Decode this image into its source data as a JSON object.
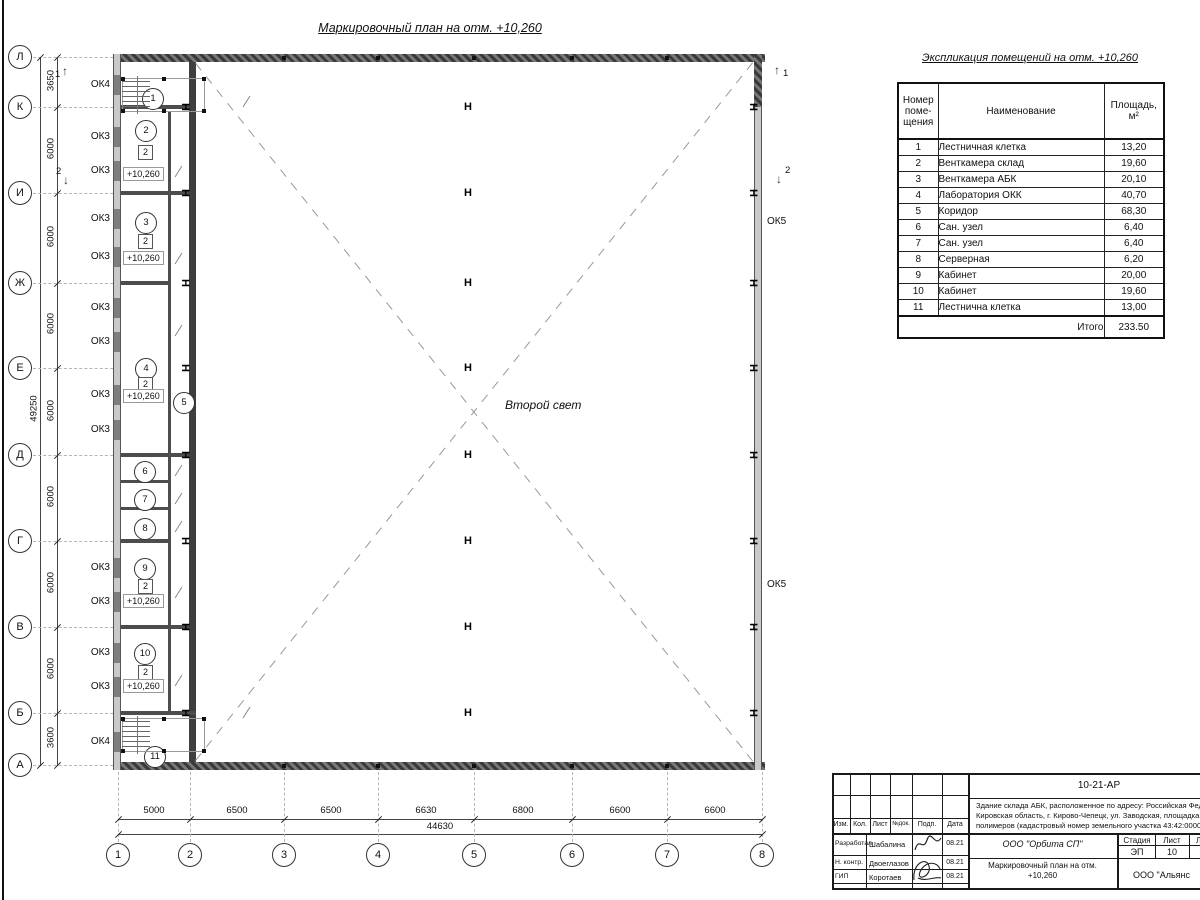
{
  "sheet": {
    "plan_title": "Маркировочный план на отм. +10,260",
    "second_light": "Второй свет"
  },
  "plan": {
    "row_axes": [
      {
        "label": "Л",
        "y": 57
      },
      {
        "label": "К",
        "y": 107
      },
      {
        "label": "И",
        "y": 193
      },
      {
        "label": "Ж",
        "y": 283
      },
      {
        "label": "Е",
        "y": 368
      },
      {
        "label": "Д",
        "y": 455
      },
      {
        "label": "Г",
        "y": 541
      },
      {
        "label": "В",
        "y": 627
      },
      {
        "label": "Б",
        "y": 713
      },
      {
        "label": "А",
        "y": 765
      }
    ],
    "col_axes": [
      {
        "label": "1",
        "x": 118
      },
      {
        "label": "2",
        "x": 190
      },
      {
        "label": "3",
        "x": 284
      },
      {
        "label": "4",
        "x": 378
      },
      {
        "label": "5",
        "x": 474
      },
      {
        "label": "6",
        "x": 572
      },
      {
        "label": "7",
        "x": 667
      },
      {
        "label": "8",
        "x": 762
      }
    ],
    "v_dims": [
      {
        "text": "3650",
        "y": 82
      },
      {
        "text": "6000",
        "y": 150
      },
      {
        "text": "6000",
        "y": 238
      },
      {
        "text": "6000",
        "y": 325
      },
      {
        "text": "6000",
        "y": 412
      },
      {
        "text": "6000",
        "y": 498
      },
      {
        "text": "6000",
        "y": 584
      },
      {
        "text": "6000",
        "y": 670
      },
      {
        "text": "3600",
        "y": 739
      }
    ],
    "v_total": {
      "text": "49250",
      "y": 410
    },
    "h_dims": [
      {
        "text": "5000",
        "x": 154
      },
      {
        "text": "6500",
        "x": 237
      },
      {
        "text": "6500",
        "x": 331
      },
      {
        "text": "6630",
        "x": 426
      },
      {
        "text": "6800",
        "x": 523
      },
      {
        "text": "6600",
        "x": 620
      },
      {
        "text": "6600",
        "x": 715
      }
    ],
    "h_total": {
      "text": "44630",
      "x": 440
    },
    "windows": [
      {
        "t": "ОК4",
        "y": 85
      },
      {
        "t": "ОК3",
        "y": 137
      },
      {
        "t": "ОК3",
        "y": 171
      },
      {
        "t": "ОК3",
        "y": 219
      },
      {
        "t": "ОК3",
        "y": 257
      },
      {
        "t": "ОК3",
        "y": 308
      },
      {
        "t": "ОК3",
        "y": 342
      },
      {
        "t": "ОК3",
        "y": 395
      },
      {
        "t": "ОК3",
        "y": 430
      },
      {
        "t": "ОК3",
        "y": 568
      },
      {
        "t": "ОК3",
        "y": 602
      },
      {
        "t": "ОК3",
        "y": 653
      },
      {
        "t": "ОК3",
        "y": 687
      },
      {
        "t": "ОК4",
        "y": 742
      }
    ],
    "ok5_labels": [
      {
        "t": "ОК5",
        "y": 222
      },
      {
        "t": "ОК5",
        "y": 585
      }
    ],
    "room_marks": [
      {
        "n": "1",
        "x": 152,
        "y": 98
      },
      {
        "n": "2",
        "x": 145,
        "y": 130
      },
      {
        "n": "3",
        "x": 145,
        "y": 222
      },
      {
        "n": "4",
        "x": 145,
        "y": 368
      },
      {
        "n": "5",
        "x": 183,
        "y": 402
      },
      {
        "n": "6",
        "x": 144,
        "y": 471
      },
      {
        "n": "7",
        "x": 144,
        "y": 499
      },
      {
        "n": "8",
        "x": 144,
        "y": 528
      },
      {
        "n": "9",
        "x": 144,
        "y": 568
      },
      {
        "n": "10",
        "x": 144,
        "y": 653
      },
      {
        "n": "11",
        "x": 154,
        "y": 756
      }
    ],
    "type_marks": [
      {
        "t": "2",
        "x": 145,
        "y": 152
      },
      {
        "t": "2",
        "x": 145,
        "y": 241
      },
      {
        "t": "2",
        "x": 145,
        "y": 384
      },
      {
        "t": "2",
        "x": 145,
        "y": 586
      },
      {
        "t": "2",
        "x": 145,
        "y": 672
      }
    ],
    "level_labels": [
      {
        "t": "+10,260",
        "x": 146,
        "y": 174
      },
      {
        "t": "+10,260",
        "x": 146,
        "y": 258
      },
      {
        "t": "+10,260",
        "x": 146,
        "y": 396
      },
      {
        "t": "+10,260",
        "x": 146,
        "y": 601
      },
      {
        "t": "+10,260",
        "x": 146,
        "y": 686
      }
    ],
    "section_marks": [
      {
        "t": "1",
        "ax": 68,
        "ay": 71,
        "lx": 59,
        "ly": 75,
        "dir": "up"
      },
      {
        "t": "1",
        "ax": 780,
        "ay": 70,
        "lx": 787,
        "ly": 74,
        "dir": "up"
      },
      {
        "t": "2",
        "ax": 69,
        "ay": 180,
        "lx": 60,
        "ly": 172,
        "dir": "down"
      },
      {
        "t": "2",
        "ax": 782,
        "ay": 179,
        "lx": 789,
        "ly": 171,
        "dir": "down"
      }
    ],
    "door_slashes": [
      [
        240,
        101
      ],
      [
        172,
        171
      ],
      [
        172,
        258
      ],
      [
        172,
        330
      ],
      [
        172,
        470
      ],
      [
        172,
        498
      ],
      [
        172,
        526
      ],
      [
        172,
        592
      ],
      [
        172,
        680
      ],
      [
        240,
        712
      ]
    ],
    "h_columns": {
      "t": "Н",
      "mid_x": 464,
      "left_x": 181,
      "right_x": 749,
      "ys": [
        107,
        193,
        283,
        368,
        455,
        541,
        627,
        713
      ]
    }
  },
  "schedule": {
    "title": "Экспликация помещений на отм. +10,260",
    "headers": [
      "Номер\nпоме-\nщения",
      "Наименование",
      "Площадь,\nм²"
    ],
    "rows": [
      [
        "1",
        "Лестничная клетка",
        "13,20"
      ],
      [
        "2",
        "Венткамера склад",
        "19,60"
      ],
      [
        "3",
        "Венткамера АБК",
        "20,10"
      ],
      [
        "4",
        "Лаборатория ОКК",
        "40,70"
      ],
      [
        "5",
        "Коридор",
        "68,30"
      ],
      [
        "6",
        "Сан. узел",
        "6,40"
      ],
      [
        "7",
        "Сан. узел",
        "6,40"
      ],
      [
        "8",
        "Серверная",
        "6,20"
      ],
      [
        "9",
        "Кабинет",
        "20,00"
      ],
      [
        "10",
        "Кабинет",
        "19,60"
      ],
      [
        "11",
        "Лестнична клетка",
        "13,00"
      ]
    ],
    "total_label": "Итого",
    "total_value": "233.50"
  },
  "title_block": {
    "doc_number": "10-21-АР",
    "description_lines": [
      "Здание склада АБК, расположенное по адресу: Российская Феде",
      "Кировская область, г. Кирово-Чепецк, ул. Заводская, площадка з",
      "полимеров (кадастровый номер земельного участка 43:42:0000"
    ],
    "header_cells": [
      "Изм.",
      "Кол.",
      "Лист",
      "№док.",
      "Подп.",
      "Дата"
    ],
    "roles": [
      {
        "role": "Разработал",
        "name": "Шабалина",
        "date": "08.21"
      },
      {
        "role": "Н. контр.",
        "name": "Двоеглазов",
        "date": "08.21"
      },
      {
        "role": "ГИП",
        "name": "Коротаев",
        "date": "08.21"
      }
    ],
    "org1": "ООО \"Орбита СП\"",
    "stage_header": [
      "Стадия",
      "Лист",
      "Листов"
    ],
    "stage_values": [
      "ЭП",
      "10",
      "1"
    ],
    "sheet_title": "Маркировочный план на отм.\n+10,260",
    "org2": "ООО \"Альянс"
  }
}
